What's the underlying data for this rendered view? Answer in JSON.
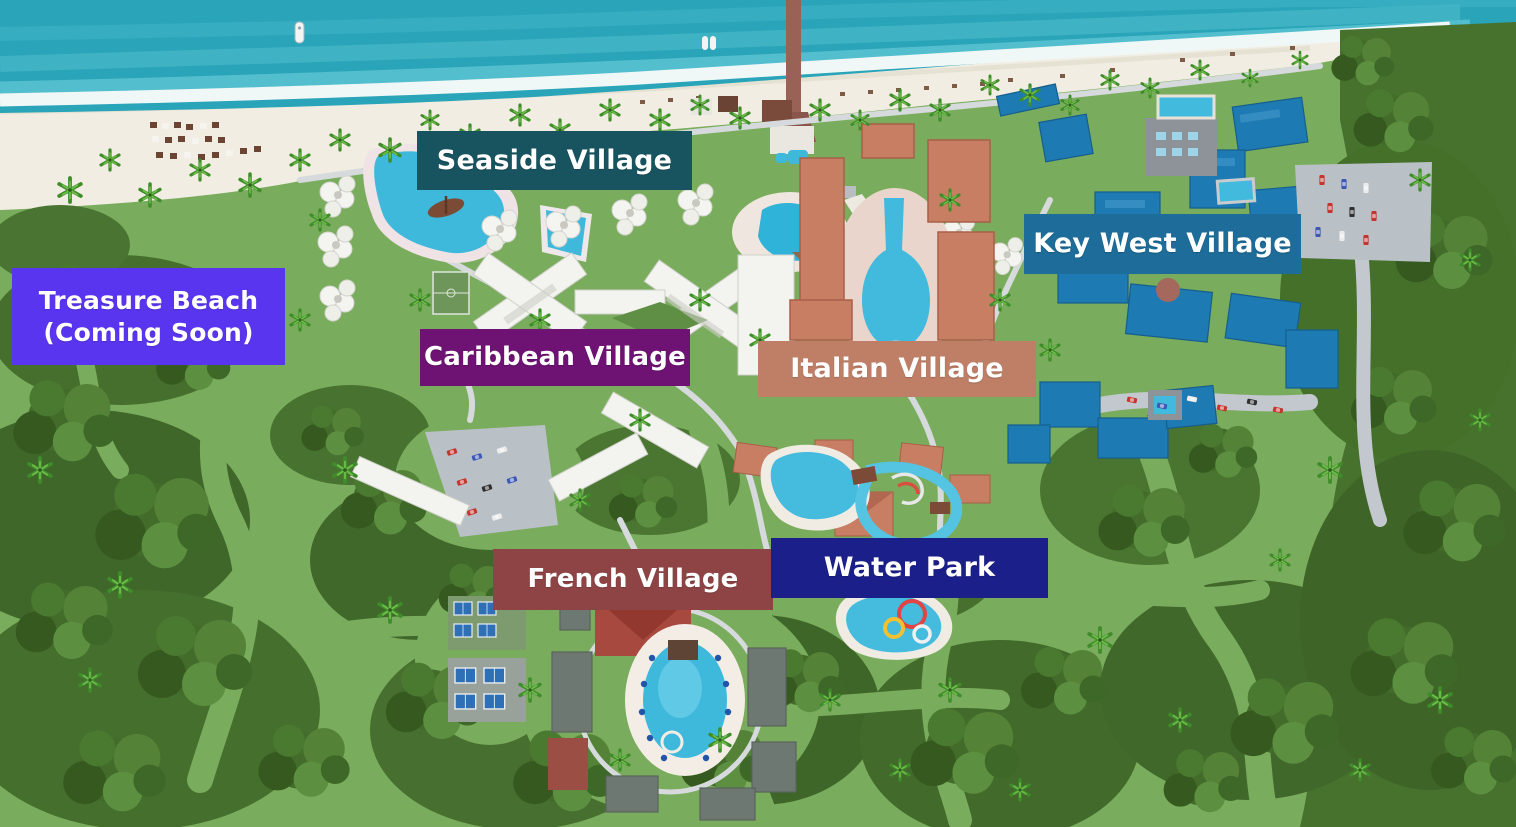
{
  "labels": [
    {
      "id": "seaside-village",
      "text": "Seaside Village",
      "color": "#185460"
    },
    {
      "id": "key-west-village",
      "text": "Key West Village",
      "color": "#1D6C99"
    },
    {
      "id": "treasure-beach",
      "text": "Treasure Beach\n(Coming Soon)",
      "color": "#5A35F0"
    },
    {
      "id": "caribbean-village",
      "text": "Caribbean Village",
      "color": "#6E1274"
    },
    {
      "id": "italian-village",
      "text": "Italian Village",
      "color": "#BF7F66"
    },
    {
      "id": "french-village",
      "text": "French Village",
      "color": "#8E4444"
    },
    {
      "id": "water-park",
      "text": "Water Park",
      "color": "#1B1F8A"
    }
  ],
  "map_palette": {
    "ocean": "#2AA4B8",
    "ocean_band_light": "#55C0CE",
    "foam": "#EFF8F7",
    "sand": "#F1EDE2",
    "grass": "#79AC5C",
    "forest": "#44702C",
    "pool_water": "#3FB9DB",
    "road": "#C2C8CD",
    "white_building": "#F3F3EF",
    "italian_roof": "#C77E63",
    "key_west_roof": "#1E7AB2",
    "french_roof": "#A8493F",
    "pier_wood": "#9A6156"
  }
}
